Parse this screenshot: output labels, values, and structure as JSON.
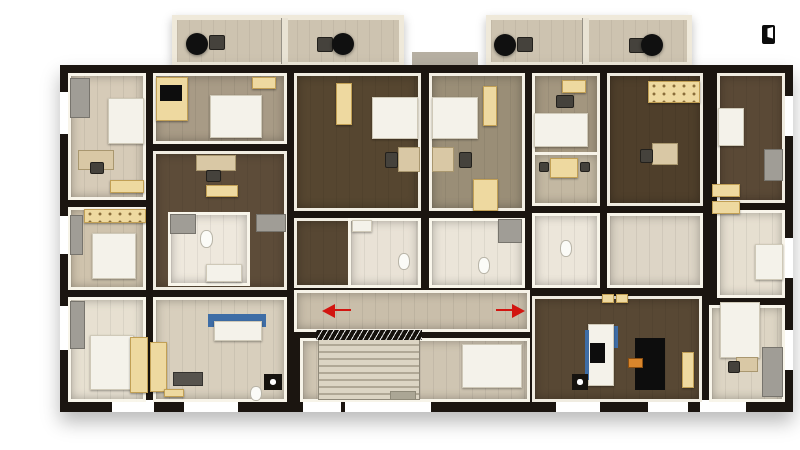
{
  "meta": {
    "description": "3D rendered apartment-building floor plan, top-down dollhouse view",
    "visible_text": "none"
  },
  "colors": {
    "background": "#ffffff",
    "outer_wall": "#1b1510",
    "wall_face": "#f8f4ea",
    "floor_dark_wood": "#564630",
    "floor_mid_wood": "#a89b86",
    "floor_light": "#e7e0d1",
    "furniture_cream": "#eed9a0",
    "furniture_white": "#f4f2ea",
    "accent_blue": "#3e6da6",
    "accent_red": "#d21510",
    "accent_orange": "#d9862c"
  },
  "icons": {
    "door_icon": "door-with-white-leaf, black glyph, top-right corner"
  },
  "scene": {
    "canvas": {
      "w": 800,
      "h": 450
    },
    "items": [
      {
        "t": "balcony",
        "n": "balcony-block-west",
        "x": 172,
        "y": 15,
        "w": 232,
        "h": 52
      },
      {
        "t": "divider",
        "n": "balcony-divider",
        "x": 281,
        "y": 18,
        "w": 7,
        "h": 46
      },
      {
        "t": "table",
        "n": "patio-table",
        "x": 186,
        "y": 33,
        "w": 22,
        "h": 22
      },
      {
        "t": "chair",
        "n": "patio-chair",
        "x": 209,
        "y": 35,
        "w": 16,
        "h": 15
      },
      {
        "t": "chair",
        "n": "patio-chair",
        "x": 317,
        "y": 37,
        "w": 16,
        "h": 15
      },
      {
        "t": "table",
        "n": "patio-table",
        "x": 332,
        "y": 33,
        "w": 22,
        "h": 22
      },
      {
        "t": "balcony",
        "n": "balcony-block-east",
        "x": 486,
        "y": 15,
        "w": 206,
        "h": 52
      },
      {
        "t": "divider",
        "n": "balcony-divider",
        "x": 582,
        "y": 18,
        "w": 7,
        "h": 46
      },
      {
        "t": "table",
        "n": "patio-table",
        "x": 494,
        "y": 34,
        "w": 22,
        "h": 22
      },
      {
        "t": "chair",
        "n": "patio-chair",
        "x": 517,
        "y": 37,
        "w": 16,
        "h": 15
      },
      {
        "t": "chair",
        "n": "patio-chair",
        "x": 629,
        "y": 38,
        "w": 16,
        "h": 15
      },
      {
        "t": "table",
        "n": "patio-table",
        "x": 641,
        "y": 34,
        "w": 22,
        "h": 22
      },
      {
        "t": "slab",
        "n": "entry-canopy",
        "x": 412,
        "y": 52,
        "w": 66,
        "h": 15
      },
      {
        "t": "building",
        "n": "building-footprint",
        "x": 60,
        "y": 65,
        "w": 733,
        "h": 347
      },
      {
        "t": "win",
        "n": "window",
        "x": 112,
        "y": 400,
        "w": 42,
        "h": 12
      },
      {
        "t": "win",
        "n": "window",
        "x": 184,
        "y": 400,
        "w": 54,
        "h": 12
      },
      {
        "t": "win",
        "n": "window",
        "x": 303,
        "y": 400,
        "w": 38,
        "h": 12
      },
      {
        "t": "win",
        "n": "entrance-opening",
        "x": 345,
        "y": 398,
        "w": 86,
        "h": 14
      },
      {
        "t": "win",
        "n": "window",
        "x": 556,
        "y": 400,
        "w": 44,
        "h": 12
      },
      {
        "t": "win",
        "n": "window",
        "x": 648,
        "y": 400,
        "w": 40,
        "h": 12
      },
      {
        "t": "win",
        "n": "window",
        "x": 700,
        "y": 400,
        "w": 46,
        "h": 12
      },
      {
        "t": "win",
        "n": "window",
        "x": 60,
        "y": 92,
        "w": 10,
        "h": 42
      },
      {
        "t": "win",
        "n": "window",
        "x": 60,
        "y": 216,
        "w": 10,
        "h": 38
      },
      {
        "t": "win",
        "n": "window",
        "x": 60,
        "y": 306,
        "w": 10,
        "h": 44
      },
      {
        "t": "win",
        "n": "window",
        "x": 783,
        "y": 96,
        "w": 10,
        "h": 40
      },
      {
        "t": "win",
        "n": "window",
        "x": 783,
        "y": 238,
        "w": 10,
        "h": 40
      },
      {
        "t": "win",
        "n": "window",
        "x": 783,
        "y": 330,
        "w": 10,
        "h": 40
      },
      {
        "t": "room",
        "n": "room-bedroom-nw",
        "x": 68,
        "y": 73,
        "w": 78,
        "h": 127,
        "c": "#d6cbb8"
      },
      {
        "t": "room",
        "n": "room-kitchen-west",
        "x": 68,
        "y": 207,
        "w": 78,
        "h": 83,
        "c": "#cfc3ad"
      },
      {
        "t": "room",
        "n": "room-bedroom-sw",
        "x": 68,
        "y": 297,
        "w": 78,
        "h": 105,
        "c": "#e7e0d1"
      },
      {
        "t": "room",
        "n": "room-bedroom-north-2",
        "x": 153,
        "y": 73,
        "w": 134,
        "h": 71,
        "c": "#a89b86"
      },
      {
        "t": "room",
        "n": "room-living-west",
        "x": 153,
        "y": 151,
        "w": 134,
        "h": 139,
        "c": "#5d4c39"
      },
      {
        "t": "room",
        "n": "room-bath-west",
        "x": 168,
        "y": 212,
        "w": 82,
        "h": 74,
        "c": "#eee8dd"
      },
      {
        "t": "room",
        "n": "room-hall-sw",
        "x": 153,
        "y": 297,
        "w": 134,
        "h": 105,
        "c": "#d8cfbd"
      },
      {
        "t": "room",
        "n": "room-bedroom-center-west",
        "x": 294,
        "y": 73,
        "w": 127,
        "h": 138,
        "c": "#564630"
      },
      {
        "t": "room",
        "n": "room-bedroom-center-east",
        "x": 429,
        "y": 73,
        "w": 96,
        "h": 138,
        "c": "#9a8e77"
      },
      {
        "t": "room",
        "n": "room-bath-center-west",
        "x": 294,
        "y": 218,
        "w": 127,
        "h": 70,
        "c": "#574733"
      },
      {
        "t": "room",
        "n": "room-bath-center-inner",
        "x": 348,
        "y": 218,
        "w": 73,
        "h": 70,
        "c": "#e9e2d6"
      },
      {
        "t": "room",
        "n": "room-bath-center-east",
        "x": 429,
        "y": 218,
        "w": 96,
        "h": 70,
        "c": "#ebe5d9"
      },
      {
        "t": "room",
        "n": "room-corridor",
        "x": 294,
        "y": 290,
        "w": 236,
        "h": 42,
        "c": "#c9beaa"
      },
      {
        "t": "room",
        "n": "room-stair-hall",
        "x": 300,
        "y": 338,
        "w": 230,
        "h": 64,
        "c": "#cfc5b2"
      },
      {
        "t": "room",
        "n": "room-bedroom-east-1",
        "x": 532,
        "y": 73,
        "w": 68,
        "h": 133,
        "c": "#a3967f"
      },
      {
        "t": "room",
        "n": "room-dining-east",
        "x": 532,
        "y": 152,
        "w": 68,
        "h": 54,
        "c": "#c3b8a2"
      },
      {
        "t": "room",
        "n": "room-bath-east",
        "x": 532,
        "y": 213,
        "w": 68,
        "h": 75,
        "c": "#ece6da"
      },
      {
        "t": "room",
        "n": "room-bedroom-east-2",
        "x": 607,
        "y": 73,
        "w": 96,
        "h": 133,
        "c": "#4f3f2b"
      },
      {
        "t": "room",
        "n": "room-hall-east",
        "x": 607,
        "y": 213,
        "w": 96,
        "h": 75,
        "c": "#ddd5c6"
      },
      {
        "t": "room",
        "n": "room-living-east",
        "x": 532,
        "y": 296,
        "w": 170,
        "h": 106,
        "c": "#584834"
      },
      {
        "t": "room",
        "n": "room-bedroom-ne",
        "x": 717,
        "y": 73,
        "w": 68,
        "h": 130,
        "c": "#5a4936"
      },
      {
        "t": "room",
        "n": "room-bedroom-east-3",
        "x": 717,
        "y": 210,
        "w": 68,
        "h": 88,
        "c": "#e6dfd0"
      },
      {
        "t": "room",
        "n": "room-bedroom-se",
        "x": 709,
        "y": 305,
        "w": 76,
        "h": 97,
        "c": "#ddd5c4"
      },
      {
        "t": "shelf",
        "n": "shelf",
        "x": 70,
        "y": 78,
        "w": 20,
        "h": 40
      },
      {
        "t": "bed",
        "n": "bed",
        "x": 108,
        "y": 98,
        "w": 36,
        "h": 46
      },
      {
        "t": "desk",
        "n": "desk",
        "x": 78,
        "y": 150,
        "w": 36,
        "h": 20
      },
      {
        "t": "chair",
        "n": "desk-chair",
        "x": 90,
        "y": 162,
        "w": 14,
        "h": 12
      },
      {
        "t": "ward",
        "n": "dresser",
        "x": 110,
        "y": 180,
        "w": 34,
        "h": 13
      },
      {
        "t": "counter",
        "n": "kitchen-counter",
        "x": 84,
        "y": 209,
        "w": 62,
        "h": 14
      },
      {
        "t": "shelf",
        "n": "shelf",
        "x": 70,
        "y": 215,
        "w": 13,
        "h": 40
      },
      {
        "t": "bed",
        "n": "refrigerator",
        "x": 92,
        "y": 233,
        "w": 44,
        "h": 46
      },
      {
        "t": "shelf",
        "n": "shelf",
        "x": 70,
        "y": 301,
        "w": 15,
        "h": 48
      },
      {
        "t": "bed",
        "n": "bed",
        "x": 90,
        "y": 335,
        "w": 44,
        "h": 55
      },
      {
        "t": "ward",
        "n": "wardrobe",
        "x": 130,
        "y": 337,
        "w": 18,
        "h": 56
      },
      {
        "t": "ward",
        "n": "wardrobe",
        "x": 150,
        "y": 342,
        "w": 17,
        "h": 50
      },
      {
        "t": "ward",
        "n": "wardrobe",
        "x": 156,
        "y": 77,
        "w": 32,
        "h": 44
      },
      {
        "t": "tv",
        "n": "tv",
        "x": 160,
        "y": 85,
        "w": 22,
        "h": 16
      },
      {
        "t": "bed",
        "n": "bed",
        "x": 210,
        "y": 95,
        "w": 52,
        "h": 43
      },
      {
        "t": "ward",
        "n": "dresser",
        "x": 252,
        "y": 77,
        "w": 24,
        "h": 12
      },
      {
        "t": "desk",
        "n": "desk",
        "x": 196,
        "y": 155,
        "w": 40,
        "h": 16
      },
      {
        "t": "chair",
        "n": "desk-chair",
        "x": 206,
        "y": 170,
        "w": 15,
        "h": 12
      },
      {
        "t": "ward",
        "n": "coffee-table",
        "x": 206,
        "y": 185,
        "w": 32,
        "h": 12
      },
      {
        "t": "shelf",
        "n": "shower",
        "x": 170,
        "y": 214,
        "w": 26,
        "h": 20
      },
      {
        "t": "toilet",
        "n": "toilet",
        "x": 200,
        "y": 230,
        "w": 13,
        "h": 18
      },
      {
        "t": "bed",
        "n": "bathtub",
        "x": 206,
        "y": 264,
        "w": 36,
        "h": 18
      },
      {
        "t": "shelf",
        "n": "appliance",
        "x": 256,
        "y": 214,
        "w": 30,
        "h": 18
      },
      {
        "t": "dark",
        "n": "washer",
        "x": 173,
        "y": 372,
        "w": 30,
        "h": 14
      },
      {
        "t": "ward",
        "n": "cabinet",
        "x": 164,
        "y": 389,
        "w": 20,
        "h": 8
      },
      {
        "t": "toilet",
        "n": "toilet",
        "x": 250,
        "y": 386,
        "w": 12,
        "h": 15
      },
      {
        "t": "blue",
        "n": "kitchen-counter-blue",
        "x": 208,
        "y": 314,
        "w": 58,
        "h": 13
      },
      {
        "t": "bed",
        "n": "kitchen-island",
        "x": 214,
        "y": 321,
        "w": 48,
        "h": 20
      },
      {
        "t": "dot",
        "n": "stove",
        "x": 264,
        "y": 374,
        "w": 18,
        "h": 16
      },
      {
        "t": "ward",
        "n": "wardrobe",
        "x": 336,
        "y": 83,
        "w": 16,
        "h": 42
      },
      {
        "t": "bed",
        "n": "bed",
        "x": 372,
        "y": 97,
        "w": 46,
        "h": 42
      },
      {
        "t": "desk",
        "n": "desk",
        "x": 398,
        "y": 147,
        "w": 22,
        "h": 25
      },
      {
        "t": "chair",
        "n": "desk-chair",
        "x": 385,
        "y": 152,
        "w": 13,
        "h": 16
      },
      {
        "t": "bed",
        "n": "bed",
        "x": 432,
        "y": 97,
        "w": 46,
        "h": 42
      },
      {
        "t": "desk",
        "n": "desk",
        "x": 432,
        "y": 147,
        "w": 22,
        "h": 25
      },
      {
        "t": "chair",
        "n": "desk-chair",
        "x": 459,
        "y": 152,
        "w": 13,
        "h": 16
      },
      {
        "t": "ward",
        "n": "wardrobe",
        "x": 483,
        "y": 86,
        "w": 14,
        "h": 40
      },
      {
        "t": "ward",
        "n": "wardrobe",
        "x": 473,
        "y": 179,
        "w": 25,
        "h": 32
      },
      {
        "t": "bed",
        "n": "sink",
        "x": 352,
        "y": 220,
        "w": 20,
        "h": 12
      },
      {
        "t": "toilet",
        "n": "toilet",
        "x": 398,
        "y": 253,
        "w": 12,
        "h": 17
      },
      {
        "t": "toilet",
        "n": "toilet",
        "x": 478,
        "y": 257,
        "w": 12,
        "h": 17
      },
      {
        "t": "shelf",
        "n": "shower",
        "x": 498,
        "y": 219,
        "w": 24,
        "h": 24
      },
      {
        "t": "stairs",
        "n": "staircase",
        "x": 318,
        "y": 338,
        "w": 102,
        "h": 62
      },
      {
        "t": "railing",
        "n": "stair-railing",
        "x": 316,
        "y": 330,
        "w": 106,
        "h": 10
      },
      {
        "t": "mat",
        "n": "floor-mat",
        "x": 390,
        "y": 391,
        "w": 26,
        "h": 9
      },
      {
        "t": "bed",
        "n": "elevator",
        "x": 462,
        "y": 344,
        "w": 60,
        "h": 44
      },
      {
        "t": "arrowL",
        "n": "exit-arrow-left",
        "x": 322,
        "y": 304,
        "w": 13,
        "h": 14
      },
      {
        "t": "red",
        "n": "exit-line-left",
        "x": 335,
        "y": 309,
        "w": 16,
        "h": 2
      },
      {
        "t": "arrowR",
        "n": "exit-arrow-right",
        "x": 512,
        "y": 304,
        "w": 13,
        "h": 14
      },
      {
        "t": "red",
        "n": "exit-line-right",
        "x": 496,
        "y": 309,
        "w": 16,
        "h": 2
      },
      {
        "t": "ward",
        "n": "stool",
        "x": 602,
        "y": 294,
        "w": 12,
        "h": 9
      },
      {
        "t": "ward",
        "n": "stool",
        "x": 616,
        "y": 294,
        "w": 12,
        "h": 9
      },
      {
        "t": "ward",
        "n": "dresser",
        "x": 562,
        "y": 80,
        "w": 24,
        "h": 13
      },
      {
        "t": "chair",
        "n": "desk-chair",
        "x": 556,
        "y": 95,
        "w": 18,
        "h": 13
      },
      {
        "t": "bed",
        "n": "bed",
        "x": 534,
        "y": 113,
        "w": 54,
        "h": 34
      },
      {
        "t": "ward",
        "n": "dining-table",
        "x": 550,
        "y": 158,
        "w": 28,
        "h": 20
      },
      {
        "t": "chair",
        "n": "chair",
        "x": 539,
        "y": 162,
        "w": 10,
        "h": 10
      },
      {
        "t": "chair",
        "n": "chair",
        "x": 580,
        "y": 162,
        "w": 10,
        "h": 10
      },
      {
        "t": "toilet",
        "n": "toilet",
        "x": 560,
        "y": 240,
        "w": 12,
        "h": 17
      },
      {
        "t": "counter",
        "n": "kitchen-counter",
        "x": 648,
        "y": 81,
        "w": 52,
        "h": 22
      },
      {
        "t": "desk",
        "n": "desk",
        "x": 652,
        "y": 143,
        "w": 26,
        "h": 22
      },
      {
        "t": "chair",
        "n": "desk-chair",
        "x": 640,
        "y": 149,
        "w": 13,
        "h": 14
      },
      {
        "t": "blue",
        "n": "counter-blue",
        "x": 612,
        "y": 326,
        "w": 6,
        "h": 22
      },
      {
        "t": "bed",
        "n": "kitchen-island",
        "x": 588,
        "y": 324,
        "w": 26,
        "h": 62
      },
      {
        "t": "blue",
        "n": "counter-blue",
        "x": 585,
        "y": 330,
        "w": 4,
        "h": 50
      },
      {
        "t": "tv",
        "n": "oven",
        "x": 590,
        "y": 343,
        "w": 15,
        "h": 20
      },
      {
        "t": "dot",
        "n": "stove",
        "x": 572,
        "y": 374,
        "w": 16,
        "h": 16
      },
      {
        "t": "tv",
        "n": "sofa-black",
        "x": 635,
        "y": 338,
        "w": 30,
        "h": 52
      },
      {
        "t": "orange",
        "n": "orange-chair",
        "x": 628,
        "y": 358,
        "w": 15,
        "h": 10
      },
      {
        "t": "ward",
        "n": "cabinet",
        "x": 682,
        "y": 352,
        "w": 12,
        "h": 36
      },
      {
        "t": "bed",
        "n": "bed",
        "x": 718,
        "y": 108,
        "w": 26,
        "h": 38
      },
      {
        "t": "shelf",
        "n": "shelf",
        "x": 764,
        "y": 149,
        "w": 19,
        "h": 32
      },
      {
        "t": "ward",
        "n": "dresser",
        "x": 712,
        "y": 184,
        "w": 28,
        "h": 13
      },
      {
        "t": "ward",
        "n": "dresser",
        "x": 712,
        "y": 201,
        "w": 28,
        "h": 13
      },
      {
        "t": "bed",
        "n": "wardrobe-white",
        "x": 755,
        "y": 244,
        "w": 28,
        "h": 36
      },
      {
        "t": "bed",
        "n": "bed",
        "x": 720,
        "y": 302,
        "w": 40,
        "h": 56
      },
      {
        "t": "desk",
        "n": "desk",
        "x": 736,
        "y": 357,
        "w": 22,
        "h": 15
      },
      {
        "t": "chair",
        "n": "desk-chair",
        "x": 728,
        "y": 361,
        "w": 12,
        "h": 12
      },
      {
        "t": "shelf",
        "n": "shelf",
        "x": 762,
        "y": 347,
        "w": 21,
        "h": 50
      },
      {
        "t": "door",
        "n": "door-icon",
        "x": 762,
        "y": 25,
        "w": 13,
        "h": 19,
        "i": true
      }
    ]
  }
}
